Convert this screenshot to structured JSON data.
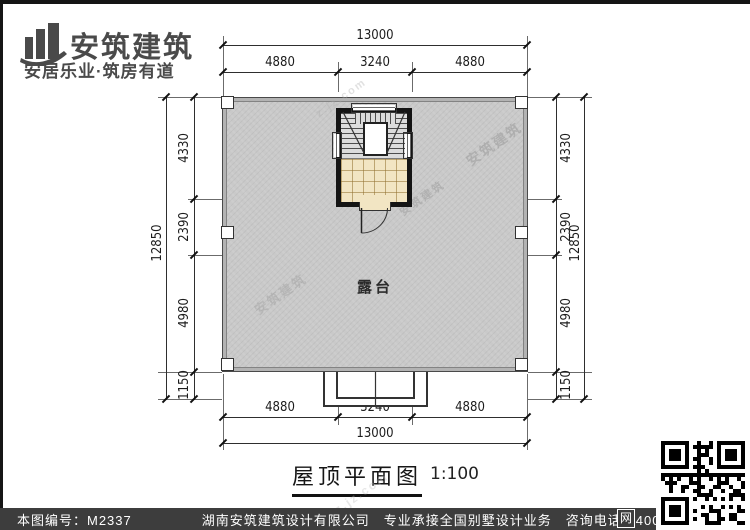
{
  "logo": {
    "name": "安筑建筑",
    "tagline": "安居乐业·筑房有道"
  },
  "plan": {
    "room_label": "露台",
    "title": "屋顶平面图",
    "scale": "1:100",
    "dims": {
      "top": {
        "overall": "13000",
        "segments": [
          "4880",
          "3240",
          "4880"
        ]
      },
      "bottom": {
        "overall": "13000",
        "segments": [
          "4880",
          "3240",
          "4880"
        ]
      },
      "left": {
        "overall": "12850",
        "segments": [
          "4330",
          "2390",
          "4980",
          "1150"
        ]
      },
      "right": {
        "overall": "12850",
        "segments": [
          "4330",
          "2390",
          "4980",
          "1150"
        ]
      }
    }
  },
  "footer": {
    "drawing_no": "本图编号：M2337",
    "company": "湖南安筑建筑设计有限公司",
    "service": "专业承接全国别墅设计业务",
    "phone": "咨询电话：400-8070-511",
    "web_badge": "网"
  },
  "watermarks": [
    "安筑建筑",
    "z.jz.com"
  ]
}
